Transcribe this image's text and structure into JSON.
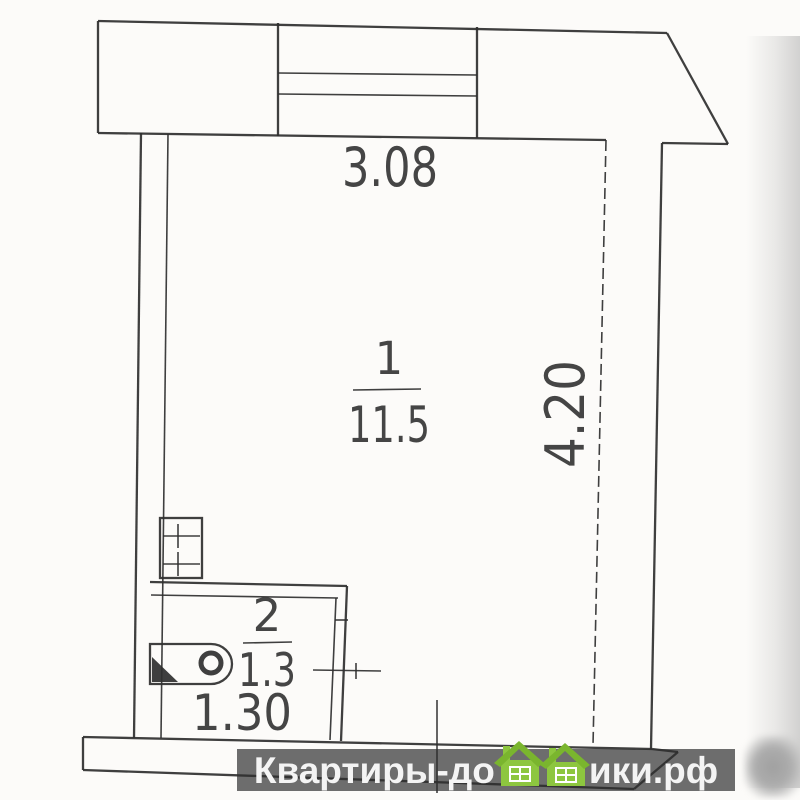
{
  "colors": {
    "ink": "#2f2f2f",
    "paper": "#fcfbf9",
    "band": "#6d6d6d",
    "watermark_text": "#f4f4f4",
    "house_green": "#8dc63f",
    "house_roof": "#7ab52e"
  },
  "plan": {
    "rooms": {
      "room1": {
        "number": "1",
        "area": "11.5"
      },
      "room2": {
        "number": "2",
        "area": "1.3"
      }
    },
    "dimensions": {
      "top_width": "3.08",
      "right_height": "4.20",
      "room2_width": "1.30"
    }
  },
  "watermark": {
    "left": "Квартиры-до",
    "right": "ики.рф",
    "icon": "twin-green-houses"
  }
}
